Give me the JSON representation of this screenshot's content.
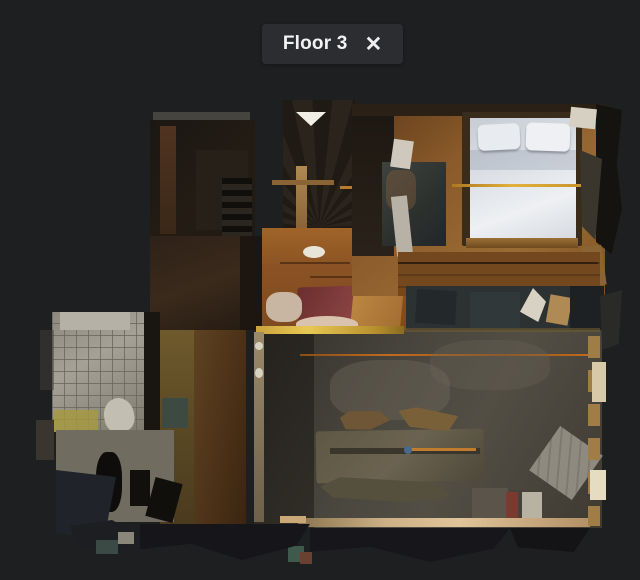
{
  "header": {
    "title": "Floor 3",
    "close_icon": "✕"
  },
  "floorplan": {
    "view": "top-down floorplan scan of floor 3"
  },
  "theme": {
    "background": "#1e1f21",
    "panel": "#2c2d30",
    "text": "#f2f2f2",
    "bedroom_wood_floor": "#8a5a2a",
    "bed_linen": "#dfe3e8",
    "red_daybed": "#7a3646",
    "accent_gold": "#e0b23c",
    "accent_orange": "#c06a1e",
    "lower_room_floor": "#4a473f",
    "bathroom_tile": "#8c887c"
  }
}
